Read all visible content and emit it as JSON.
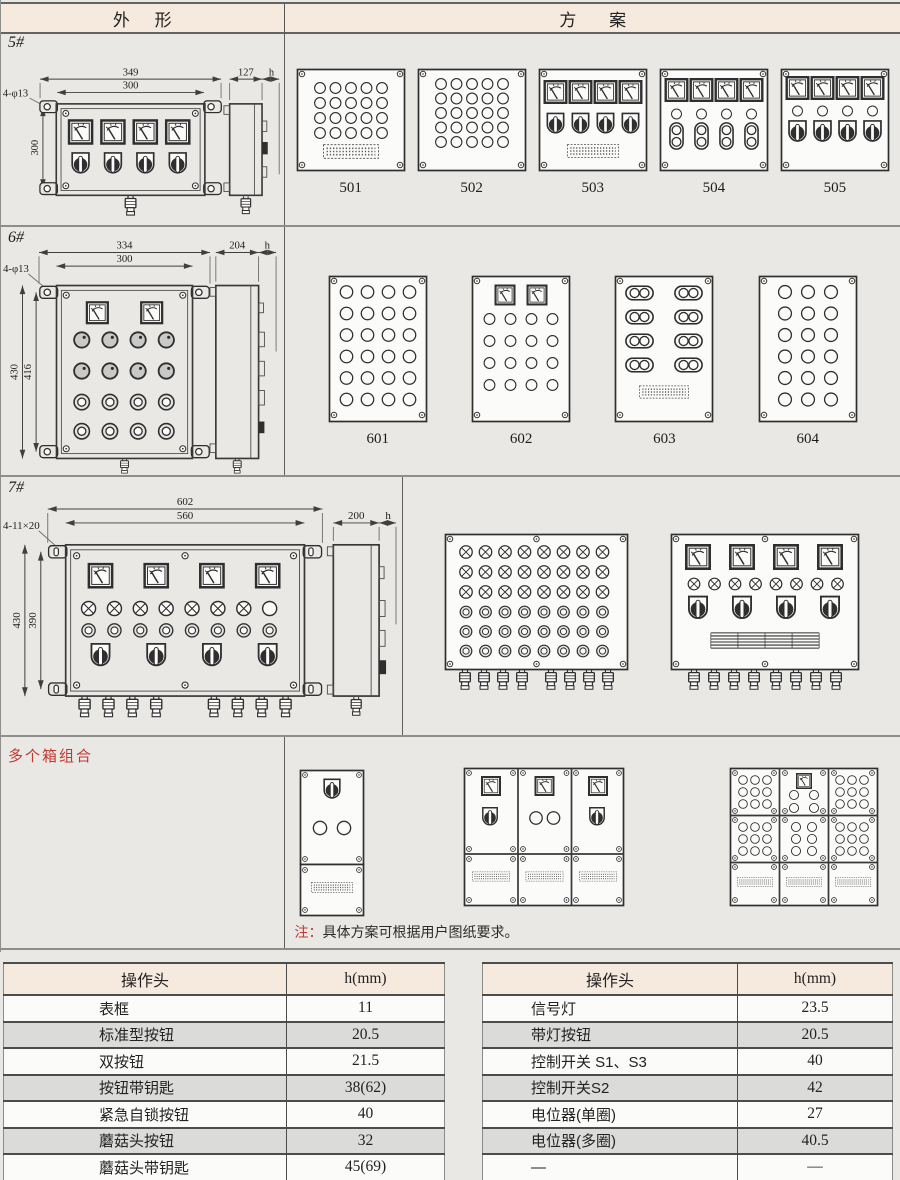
{
  "page": {
    "bg": "#e9e8e5",
    "accent_red": "#c0392f",
    "band_bg": "#f6e9dd",
    "row_alt": "#dbdbd9"
  },
  "header": {
    "outline": "外 形",
    "scheme": "方 案"
  },
  "s5": {
    "label": "5#",
    "schemes": [
      "501",
      "502",
      "503",
      "504",
      "505"
    ],
    "dims": {
      "w_overall": "349",
      "w_box": "300",
      "holes": "4-φ13",
      "h_box": "300",
      "depth": "127",
      "head": "h"
    }
  },
  "s6": {
    "label": "6#",
    "schemes": [
      "601",
      "602",
      "603",
      "604"
    ],
    "dims": {
      "w_overall": "334",
      "w_box": "300",
      "holes": "4-φ13",
      "h_overall": "430",
      "h_box": "416",
      "depth": "204",
      "head": "h"
    }
  },
  "s7": {
    "label": "7#",
    "dims": {
      "w_overall": "602",
      "w_box": "560",
      "holes": "4-11×20",
      "h_overall": "430",
      "h_box": "390",
      "depth": "200",
      "head": "h"
    }
  },
  "combo": {
    "label": "多个箱组合",
    "note_prefix": "注：",
    "note_body": "具体方案可根据用户图纸要求。"
  },
  "tables": {
    "left": {
      "headers": [
        "操作头",
        "h(mm)"
      ],
      "rows": [
        [
          "表框",
          "11"
        ],
        [
          "标准型按钮",
          "20.5"
        ],
        [
          "双按钮",
          "21.5"
        ],
        [
          "按钮带钥匙",
          "38(62)"
        ],
        [
          "紧急自锁按钮",
          "40"
        ],
        [
          "蘑菇头按钮",
          "32"
        ],
        [
          "蘑菇头带钥匙",
          "45(69)"
        ]
      ]
    },
    "right": {
      "headers": [
        "操作头",
        "h(mm)"
      ],
      "rows": [
        [
          "信号灯",
          "23.5"
        ],
        [
          "带灯按钮",
          "20.5"
        ],
        [
          "控制开关 S1、S3",
          "40"
        ],
        [
          "控制开关S2",
          "42"
        ],
        [
          "电位器(单圈)",
          "27"
        ],
        [
          "电位器(多圈)",
          "40.5"
        ],
        [
          "—",
          "—"
        ]
      ]
    }
  }
}
